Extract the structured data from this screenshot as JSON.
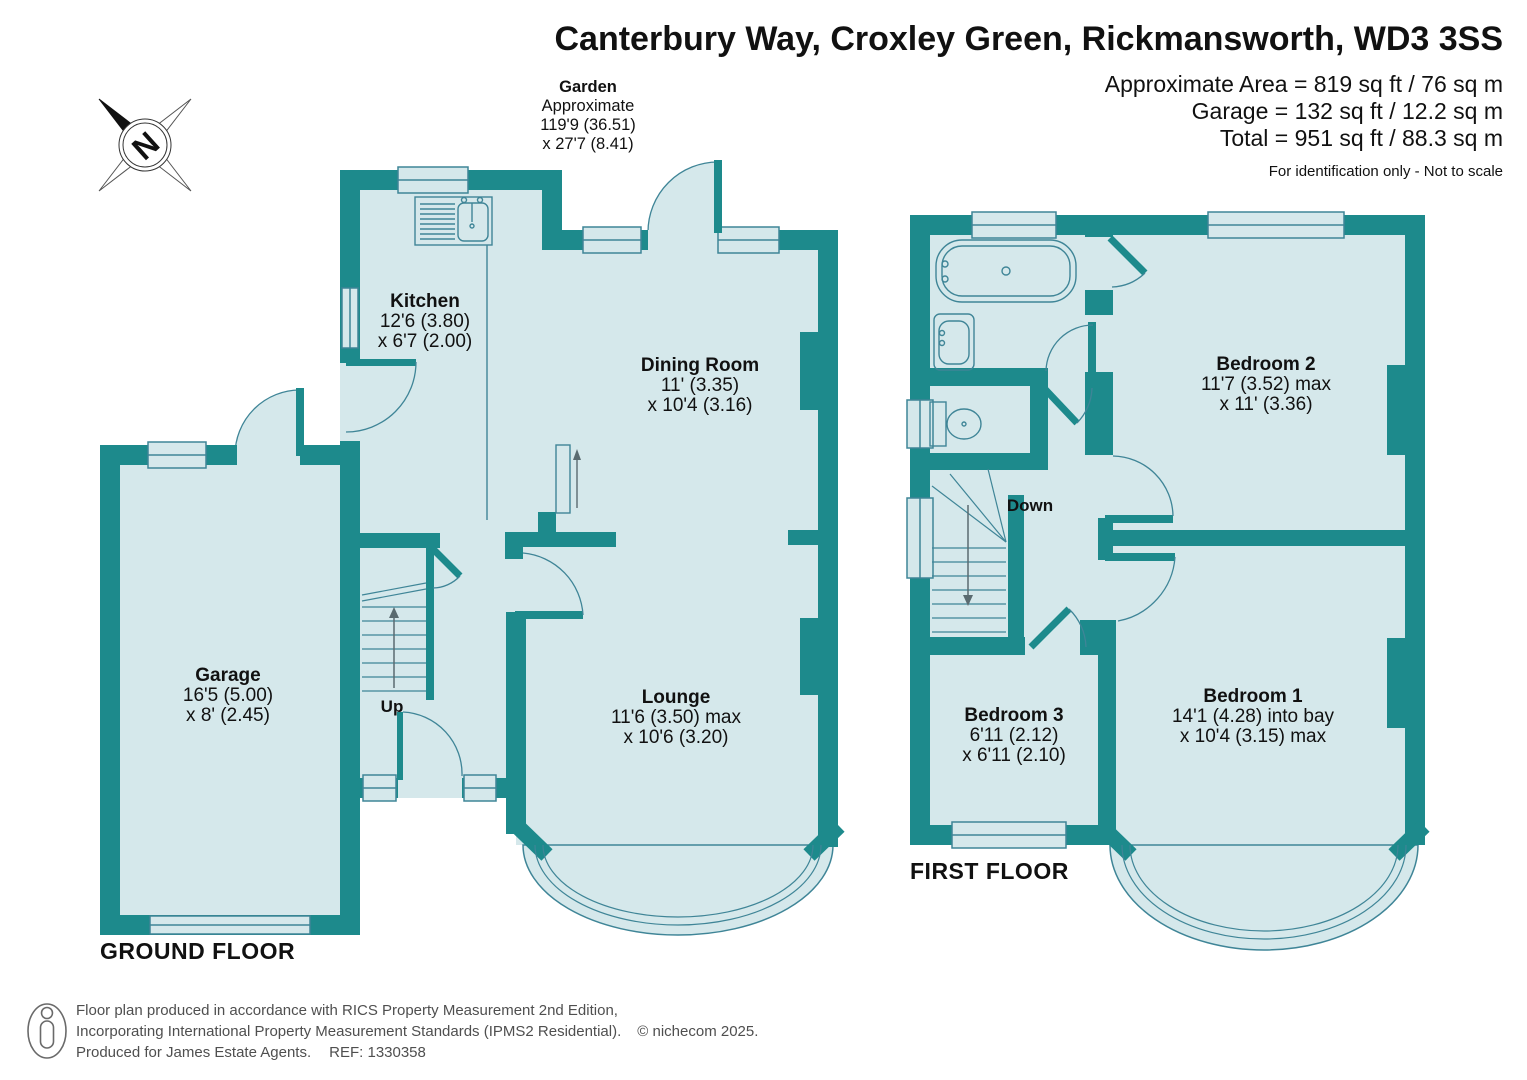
{
  "header": {
    "title": "Canterbury Way, Croxley Green, Rickmansworth, WD3 3SS",
    "area_line1": "Approximate Area = 819 sq ft / 76 sq m",
    "area_line2": "Garage = 132 sq ft / 12.2 sq m",
    "area_line3": "Total = 951 sq ft / 88.3 sq m",
    "disclaimer": "For identification only - Not to scale"
  },
  "garden": {
    "title": "Garden",
    "line1": "Approximate",
    "line2": "119'9 (36.51)",
    "line3": "x 27'7 (8.41)"
  },
  "compass": {
    "letter": "N"
  },
  "ground_floor": {
    "label": "GROUND FLOOR",
    "stairs_label": "Up",
    "rooms": {
      "garage": {
        "name": "Garage",
        "dim1": "16'5 (5.00)",
        "dim2": "x 8' (2.45)"
      },
      "kitchen": {
        "name": "Kitchen",
        "dim1": "12'6 (3.80)",
        "dim2": "x 6'7 (2.00)"
      },
      "dining_room": {
        "name": "Dining Room",
        "dim1": "11' (3.35)",
        "dim2": "x 10'4 (3.16)"
      },
      "lounge": {
        "name": "Lounge",
        "dim1": "11'6 (3.50) max",
        "dim2": "x 10'6 (3.20)"
      }
    }
  },
  "first_floor": {
    "label": "FIRST FLOOR",
    "stairs_label": "Down",
    "rooms": {
      "bedroom1": {
        "name": "Bedroom 1",
        "dim1": "14'1 (4.28) into bay",
        "dim2": "x 10'4 (3.15) max"
      },
      "bedroom2": {
        "name": "Bedroom 2",
        "dim1": "11'7 (3.52) max",
        "dim2": "x 11' (3.36)"
      },
      "bedroom3": {
        "name": "Bedroom 3",
        "dim1": "6'11 (2.12)",
        "dim2": "x 6'11 (2.10)"
      }
    }
  },
  "footer": {
    "line1": "Floor plan produced in accordance with RICS Property Measurement 2nd Edition,",
    "line2": "Incorporating International Property Measurement Standards (IPMS2 Residential).",
    "copyright": "© nichecom 2025.",
    "line3": "Produced for James Estate Agents.",
    "ref": "REF: 1330358"
  },
  "colors": {
    "wall": "#1d8a8c",
    "room_fill": "#d5e8eb",
    "fixture_line": "#3f8597"
  }
}
